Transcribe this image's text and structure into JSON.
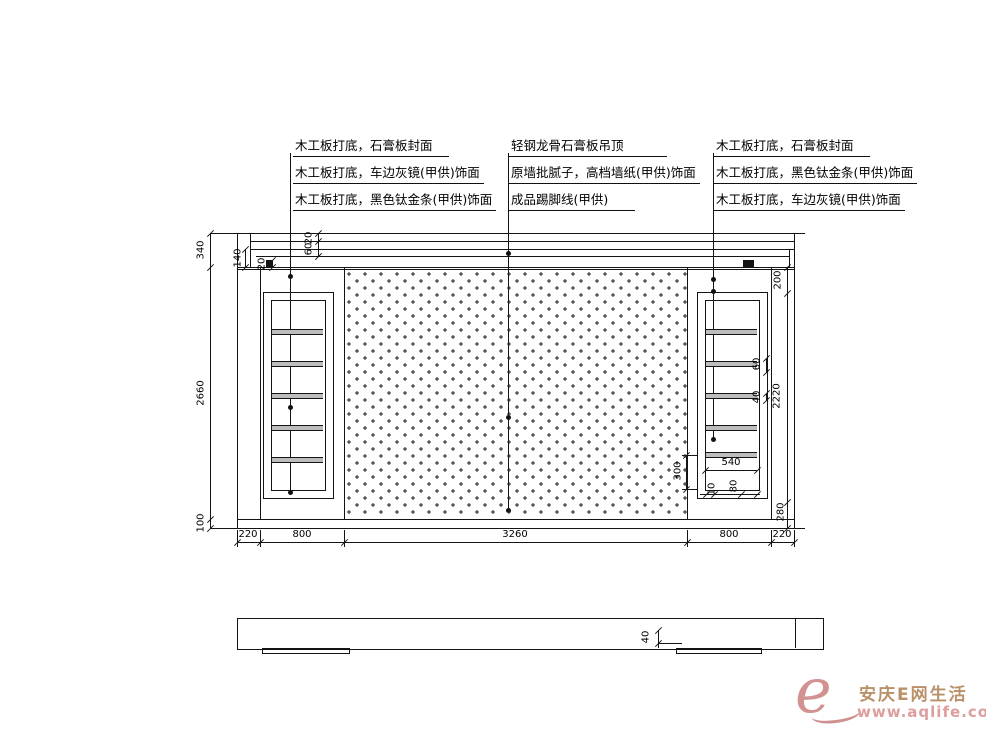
{
  "annotations": {
    "left": [
      "木工板打底，石膏板封面",
      "木工板打底，车边灰镜(甲供)饰面",
      "木工板打底，黑色钛金条(甲供)饰面"
    ],
    "middle": [
      "轻钢龙骨石膏板吊顶",
      "原墙批腻子，高档墙纸(甲供)饰面",
      "成品踢脚线(甲供)"
    ],
    "right": [
      "木工板打底，石膏板封面",
      "木工板打底，黑色钛金条(甲供)饰面",
      "木工板打底，车边灰镜(甲供)饰面"
    ]
  },
  "dimensions": {
    "left_chain": {
      "d340": "340",
      "d2660": "2660",
      "d100": "100"
    },
    "top_details": {
      "d140": "140",
      "d20_step": "20",
      "d20_band": "20",
      "d60": "60"
    },
    "bottom_chain": {
      "c220l": "220",
      "c800l": "800",
      "c3260": "3260",
      "c800r": "800",
      "c220r": "220"
    },
    "right_chain": {
      "d200": "200",
      "d2220": "2220",
      "d280": "280"
    },
    "panel_details": {
      "d60": "60",
      "d40": "40",
      "d300": "300",
      "d540": "540",
      "d10": "10",
      "d80": "80"
    },
    "plan_view": {
      "d40": "40"
    }
  },
  "watermark": {
    "logo": "e",
    "site_name": "安庆E网生活",
    "url": "www.aqlife.com"
  },
  "colors": {
    "line": "#141414",
    "watermark_pink": "#dd9e9e",
    "watermark_tan": "#b99068"
  }
}
